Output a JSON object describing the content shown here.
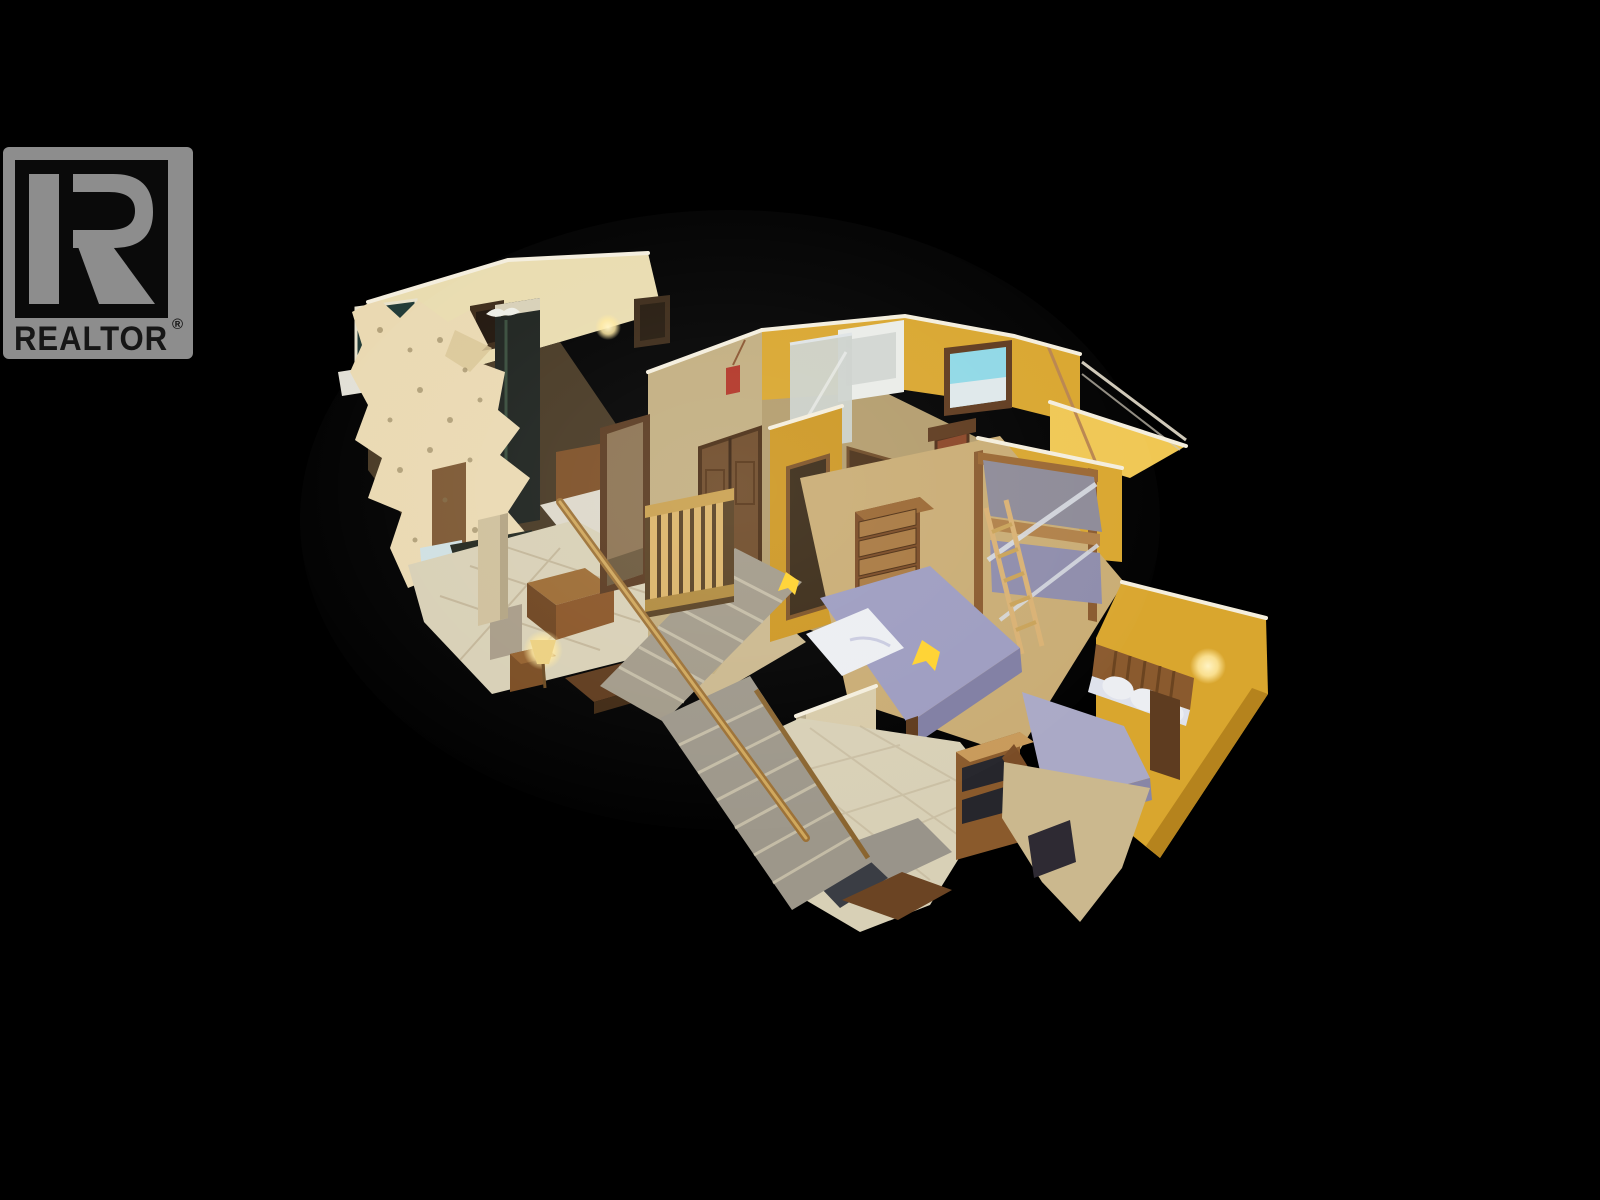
{
  "watermark": {
    "wordmark": "REALTOR",
    "registered_symbol": "®",
    "logo_letter": "R"
  },
  "scene": {
    "type": "3d-dollhouse-cutaway",
    "style": "matterport-style real-estate 3D tour snapshot",
    "view": "overhead isometric cutaway of a two-story home interior on black",
    "rooms": [
      "living-room",
      "upper-hallway",
      "bathroom",
      "bunk-bedroom",
      "queen-bedroom",
      "lower-bedroom",
      "entry-foyer",
      "staircase"
    ],
    "marker_count": 3
  },
  "palette": {
    "background": "#000000",
    "logo-gray": "#8d8d8d",
    "logo-text": "#161616",
    "wall-gold": "#d9a62e",
    "wall-gold-light": "#f0c753",
    "wall-gold-dark": "#b5831d",
    "wall-cream": "#e9dcb0",
    "wall-khaki": "#c2ae80",
    "wall-cut-edge": "#f4eedd",
    "ragged-plaster": "#ead9b2",
    "floor-tile": "#d8d0b6",
    "floor-carpet": "#c9ac74",
    "floor-carpet-tan": "#cbb88e",
    "stair-gray": "#9d978a",
    "wood-dark": "#5e3a1c",
    "wood-mid": "#7d4f26",
    "wood-light": "#c89348",
    "wood-golden": "#d9b368",
    "bed-lavender": "#9d9cc0",
    "bed-lavender-dark": "#807ea3",
    "bunk-gray": "#8d8a97",
    "bedding-white": "#eceef2",
    "window-sky": "#8fd8e6",
    "glow-warm": "#ffe9a0",
    "marker-yellow": "#ffd22e",
    "shower-glass": "#ccd2cc",
    "door-red": "#8a4526"
  }
}
